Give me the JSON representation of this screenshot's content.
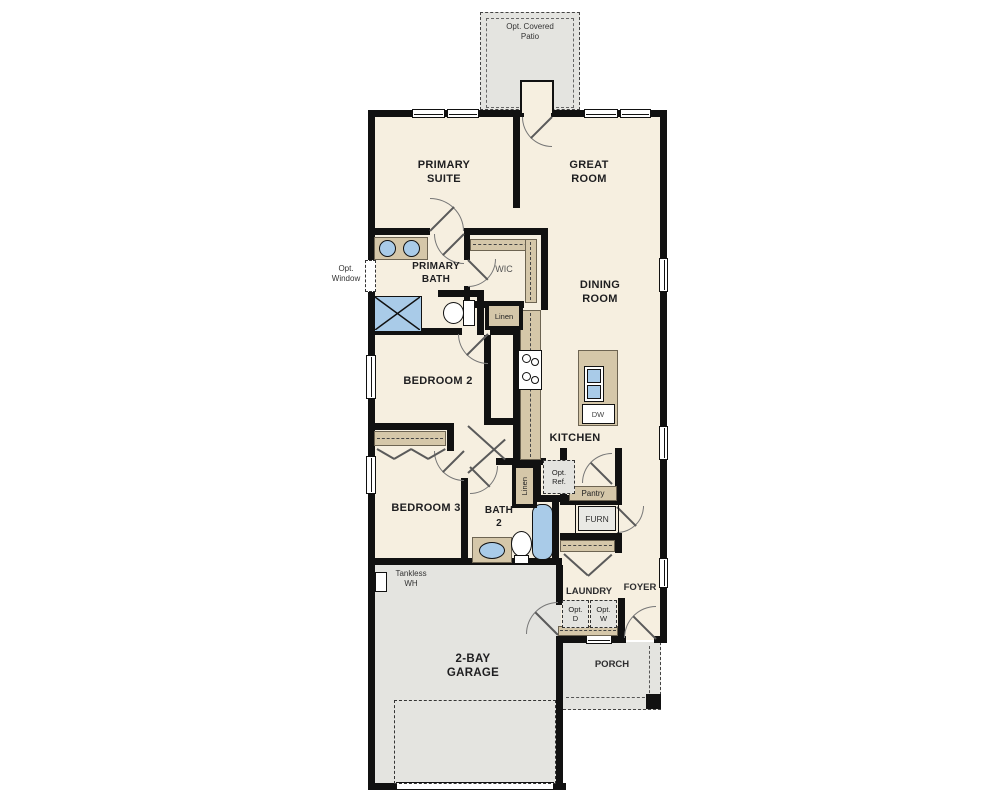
{
  "labels": {
    "patio": "Opt. Covered Patio",
    "primary_suite": "PRIMARY SUITE",
    "great_room": "GREAT ROOM",
    "opt_window": "Opt. Window",
    "primary_bath": "PRIMARY BATH",
    "wic": "WIC",
    "linen_upper": "Linen",
    "dining_room": "DINING ROOM",
    "bedroom_2": "BEDROOM 2",
    "kitchen": "KITCHEN",
    "dishwasher": "DW",
    "bedroom_3": "BEDROOM 3",
    "bath_2": "BATH 2",
    "linen_lower": "Linen",
    "opt_ref": "Opt. Ref.",
    "pantry": "Pantry",
    "furnace": "FURN",
    "tankless": "Tankless WH",
    "laundry": "LAUNDRY",
    "opt_dryer": "Opt. D",
    "opt_washer": "Opt. W",
    "foyer": "FOYER",
    "garage": "2-BAY GARAGE",
    "porch": "PORCH"
  },
  "colors": {
    "wall": "#111111",
    "interior_floor": "#f6efe0",
    "concrete_floor": "#e4e4e0",
    "cabinet_tan": "#d5c7a9",
    "fixture_blue": "#a9cbe8"
  }
}
